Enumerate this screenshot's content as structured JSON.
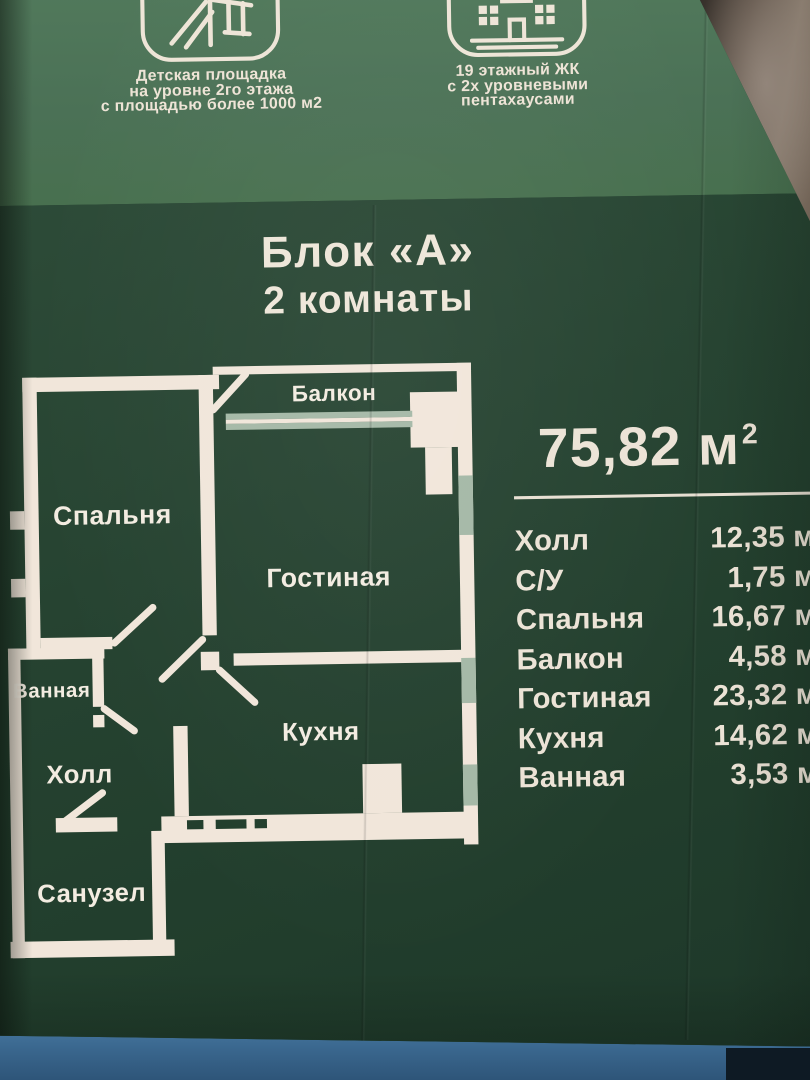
{
  "header": {
    "features": [
      {
        "icon": "playground-icon",
        "lines": [
          "Детская площадка",
          "на уровне 2го этажа",
          "с площадью более 1000 м2"
        ]
      },
      {
        "icon": "building-icon",
        "lines": [
          "19 этажный ЖК",
          "с 2х уровневыми",
          "пентахаусами"
        ]
      }
    ]
  },
  "block": {
    "title": "Блок «А»",
    "subtitle": "2 комнаты"
  },
  "plan": {
    "labels": {
      "balkon": "Балкон",
      "spalnya": "Спальня",
      "gostinaya": "Гостиная",
      "vannaya": "Ванная",
      "holl": "Холл",
      "kuhnya": "Кухня",
      "sanuzel": "Санузел"
    }
  },
  "summary": {
    "total_number": "75,82",
    "total_unit": "м",
    "total_power": "2"
  },
  "areas": [
    {
      "label": "Холл",
      "value": "12,35 м²"
    },
    {
      "label": "С/У",
      "value": "1,75 м²"
    },
    {
      "label": "Спальня",
      "value": "16,67 м²"
    },
    {
      "label": "Балкон",
      "value": "4,58 м²"
    },
    {
      "label": "Гостиная",
      "value": "23,32 м²"
    },
    {
      "label": "Кухня",
      "value": "14,62 м²"
    },
    {
      "label": "Ванная",
      "value": "3,53 м²"
    }
  ],
  "colors": {
    "header_green": "#4b7156",
    "panel_green": "#24402e",
    "wall_cream": "#f1e6da",
    "window_sage": "#a4b8a6",
    "text_cream": "#ece3d6",
    "table_blue": "#3a678e"
  }
}
